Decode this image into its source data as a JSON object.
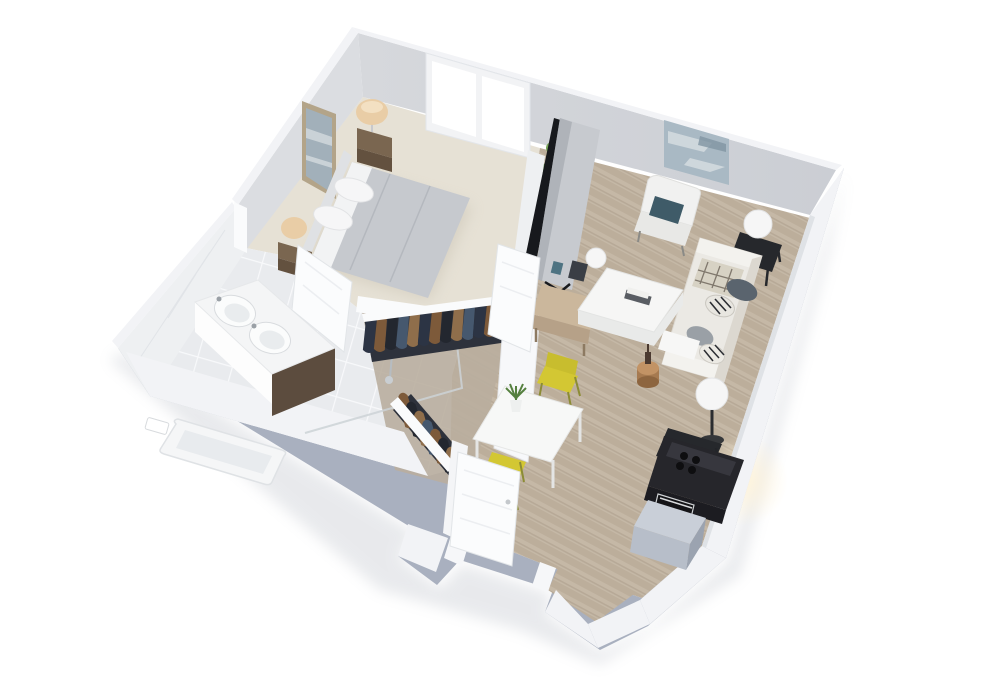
{
  "scene": {
    "title": "3D isometric cutaway rendering of a one-bedroom apartment floor plan",
    "style": "photoreal 3D floor plan on white background",
    "background": "#ffffff"
  },
  "palette": {
    "background": "#ffffff",
    "wallTop": "#f2f3f6",
    "wallOuter": "#a9b0bf",
    "wallInnerNE": "#d2d4d9",
    "wallInnerNW": "#dbdde1",
    "tileWall": "#eef0f2",
    "carpet": "#e6e1d5",
    "woodFloor": "#c5b8a6",
    "tileFloor": "#e9ebee",
    "closetFloor": "#b9ae9f",
    "doorWhite": "#fbfcfd",
    "windowPane": "#ffffff",
    "bedDuvet": "#c6c9ce",
    "bedSheet": "#f2f3f4",
    "nightstandWood": "#63513f",
    "lampShade": "#e9cda6",
    "artFrame": "#b3a489",
    "artBlue": "#a2b0ba",
    "plantGreen": "#55803f",
    "plantGreenLight": "#7aa85c",
    "potWhite": "#f6f7f7",
    "tvBack": "#c7cacf",
    "tvDark": "#17191d",
    "consoleWood": "#cbb79c",
    "sofaWhite": "#ebe9e4",
    "pillowTeal": "#3f5b68",
    "pillowGray": "#5a646e",
    "plaidThrow": "#d7d2c4",
    "coffeeTable": "#f6f6f5",
    "lampOrb": "#f6f6f6",
    "blackFurniture": "#26282c",
    "chairYellow": "#d3c733",
    "tableWhite": "#f7f8f7",
    "counterDark": "#26262b",
    "applianceGray": "#b7bec9",
    "vanityWood": "#5c4c3e",
    "sinkWhite": "#fbfcfc",
    "tubWhite": "#f5f6f7",
    "clothesNavy": "#2c3444",
    "clothesBrown": "#7d5a3a",
    "clothesDenim": "#46586e",
    "clothesDark": "#23272f",
    "clothesTan": "#8f6e4b",
    "glowWarm": "#fff3d8"
  },
  "rooms": [
    {
      "id": "bedroom",
      "name": "Bedroom",
      "floor": "beige carpet",
      "furniture": [
        "double bed with gray duvet and white pillows",
        "nightstand with table lamp (left)",
        "nightstand with table lamp (right)",
        "framed wall art",
        "window with two panes"
      ]
    },
    {
      "id": "bathroom",
      "name": "Bathroom",
      "floor": "white tile",
      "furniture": [
        "double vanity with two round sinks",
        "bathtub",
        "walk-in shower with glass panel",
        "handheld shower fixture"
      ]
    },
    {
      "id": "closet",
      "name": "Walk-in closet",
      "floor": "wood",
      "furniture": [
        "hanging clothes rack (upper)",
        "hanging clothes rack (lower)"
      ]
    },
    {
      "id": "living",
      "name": "Living room",
      "floor": "light wood planks",
      "furniture": [
        "large TV on wood media bench",
        "potted plant",
        "abstract wall art",
        "white armchair with teal pillow",
        "white sofa with pillows and plaid throw",
        "white coffee table with books",
        "orb table lamp on black console",
        "orb floor lamp",
        "black side table",
        "small wooden stool with bottle"
      ]
    },
    {
      "id": "dining",
      "name": "Dining area",
      "floor": "light wood planks",
      "furniture": [
        "square white dining table",
        "small potted plant",
        "yellow chair (upper)",
        "yellow chair (lower)"
      ]
    },
    {
      "id": "kitchen",
      "name": "Kitchen",
      "floor": "light wood planks",
      "furniture": [
        "dark counter with cooktop",
        "built-in oven",
        "gray refrigerator cabinet"
      ]
    },
    {
      "id": "entry",
      "name": "Entry vestibule",
      "floor": "light wood planks",
      "furniture": [
        "open white front door",
        "protruding vestibule walls"
      ]
    }
  ]
}
